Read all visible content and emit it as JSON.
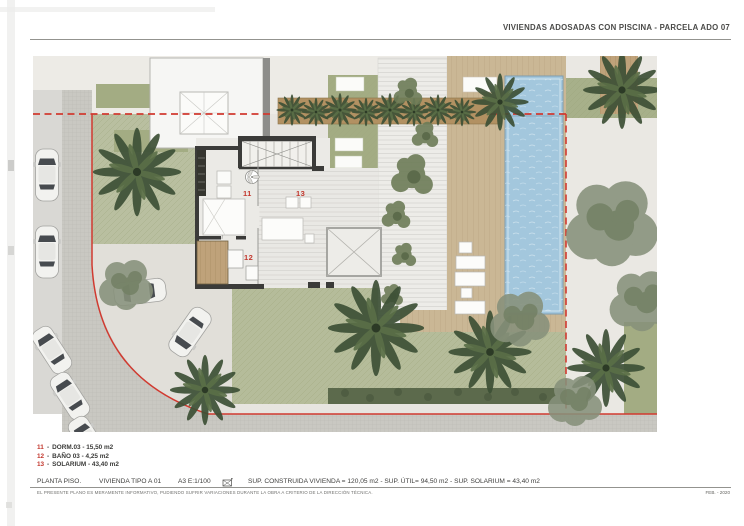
{
  "header": {
    "title": "VIVIENDAS ADOSADAS CON PISCINA - PARCELA ADO 07"
  },
  "legend": {
    "items": [
      {
        "number": "11",
        "sep": "-",
        "label": "DORM.03 - 15,50 m2"
      },
      {
        "number": "12",
        "sep": "-",
        "label": "BAÑO 03 - 4,25 m2"
      },
      {
        "number": "13",
        "sep": "-",
        "label": "SOLARIUM - 43,40 m2"
      }
    ]
  },
  "titleblock": {
    "plan_name": "PLANTA PISO.",
    "dwelling": "VIVIENDA TIPO A 01",
    "scale": "A3 E:1/100",
    "north_icon": "north-arrow",
    "areas": "SUP. CONSTRUIDA VIVIENDA = 120,05 m2 - SUP. ÚTIL= 94,50 m2 - SUP. SOLARIUM = 43,40 m2",
    "disclaimer": "EL PRESENTE PLANO ES MERAMENTE INFORMATIVO, PUDIENDO SUFRIR VARIACIONES DURANTE LA OBRA A CRITERIO DE LA DIRECCIÓN TÉCNICA.",
    "date": "FEB. - 2020"
  },
  "plan": {
    "labels": {
      "bedroom": "11",
      "bathroom": "12",
      "solarium": "13"
    }
  },
  "colors": {
    "boundary_red": "#d13a30",
    "label_red": "#c2362c",
    "pool_blue": "#a3c7dd",
    "deck_tan": "#cab795",
    "lawn_green": "#b5bc9a",
    "roof_green": "#a3ac83",
    "hedge_green": "#5c6a4c"
  }
}
